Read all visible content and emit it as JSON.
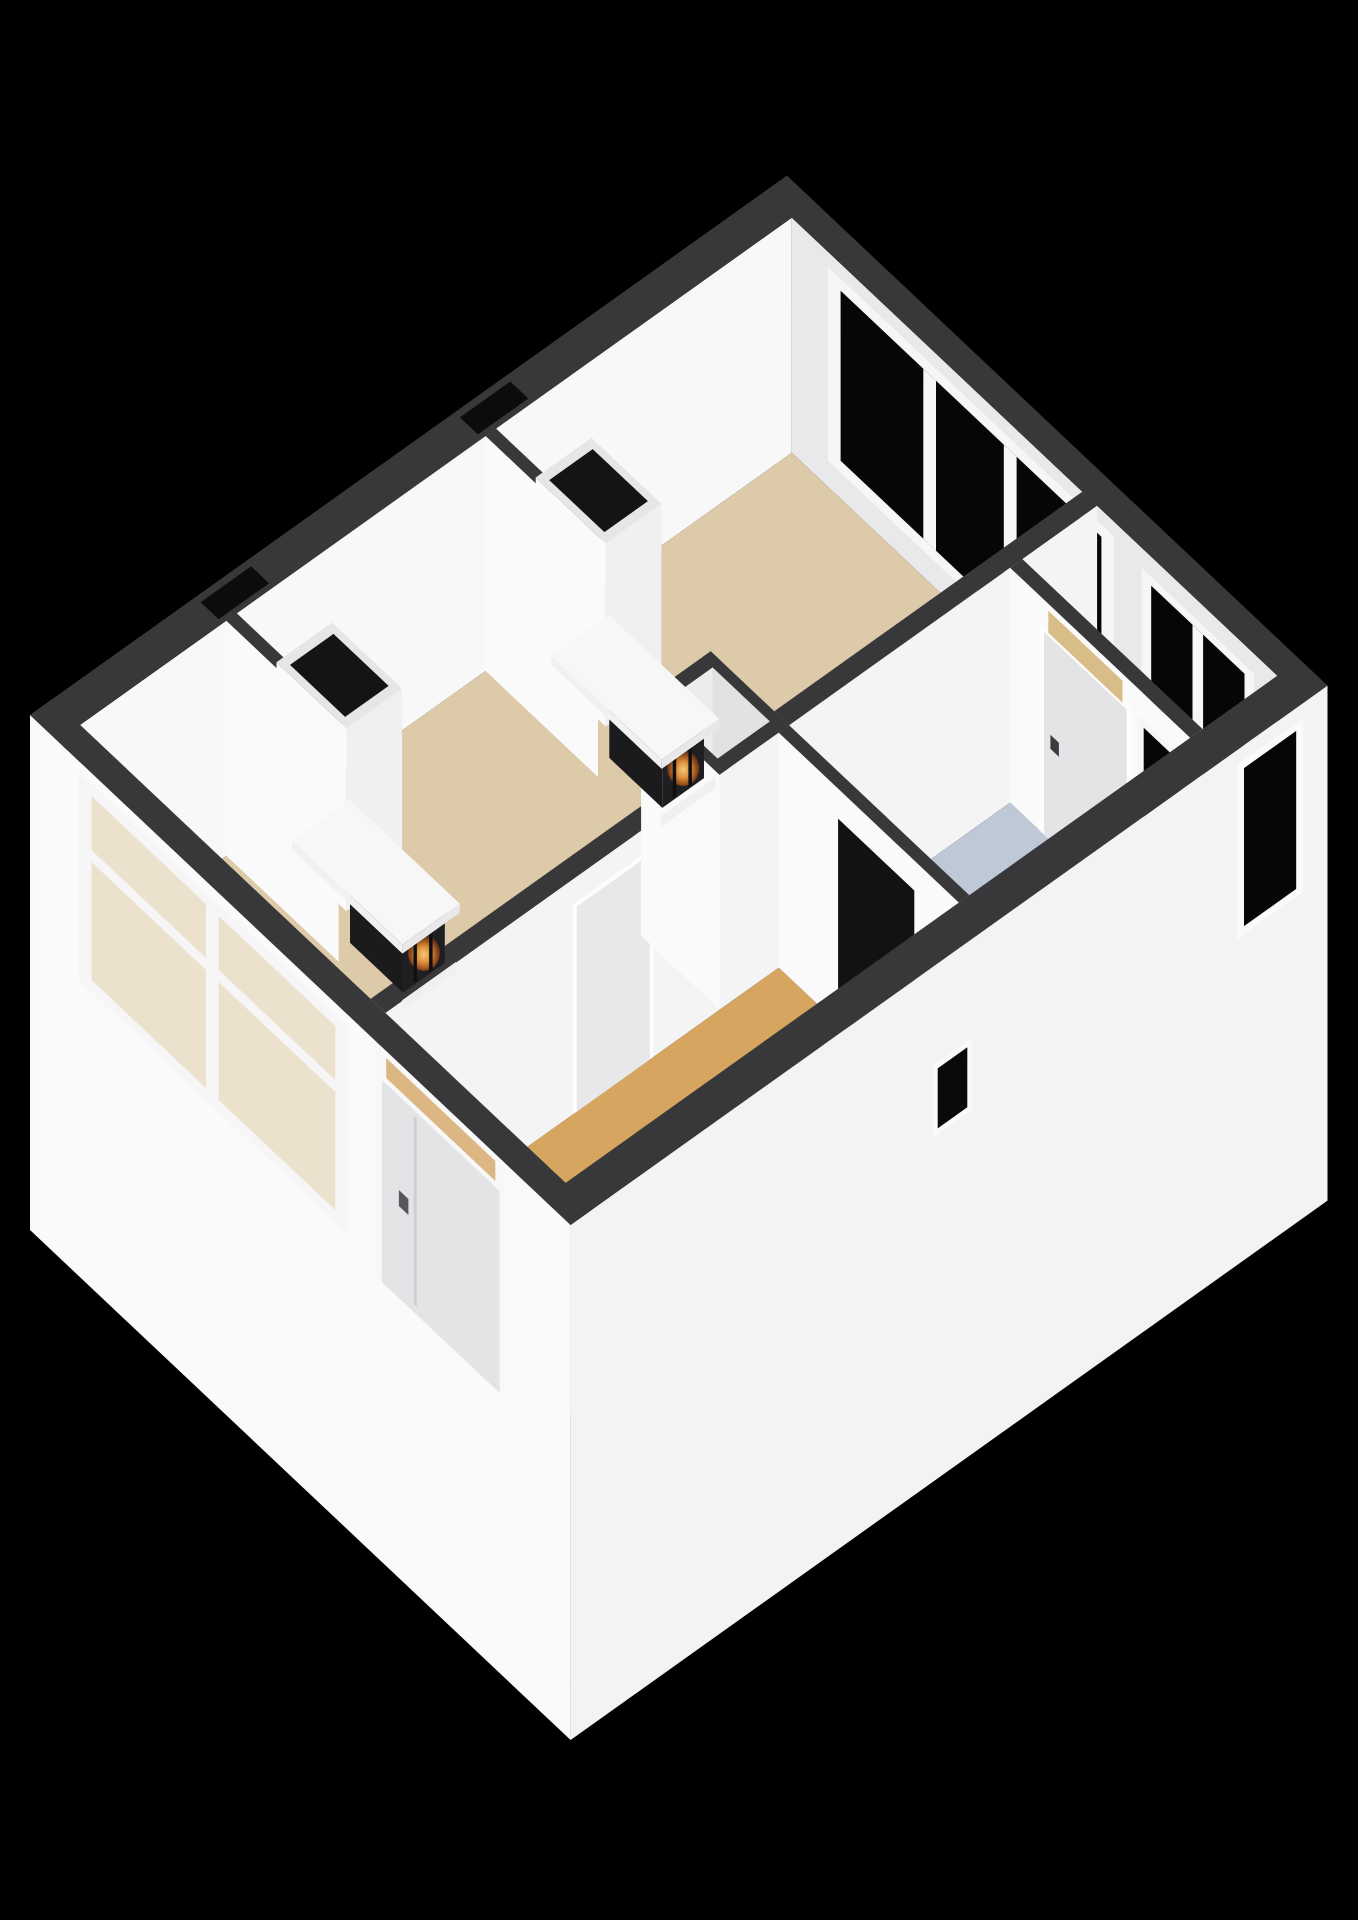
{
  "scene": {
    "type": "3d-floorplan-render",
    "view": "isometric-cutaway",
    "background": "#000000",
    "palette": {
      "wall_top": "#38383a",
      "wall_bright": "#fafafb",
      "wall_light": "#f4f4f5",
      "wall_interior": "#e9e9ec",
      "wall_shaded": "#d9d9dc",
      "frame_white": "#f6f6f7",
      "glass_dark": "#060608",
      "floor_living": "#dccaa8",
      "floor_hall": "#d6a55f",
      "floor_kitchen": "#bfc8d6",
      "floor_closet": "#d2d2d5",
      "floor_annex": "#e6d6b0",
      "door_leaf": "#e4e4e6",
      "door_handle": "#55555a",
      "transom_glass": "rgba(217,176,120,0.92)",
      "sw_glass_tint": "rgba(226,208,170,0.55)",
      "stove_body": "#1f1f22",
      "stove_side": "#1b1b1e",
      "stove_slat": "#0f0f11",
      "flue_dark": "#141416",
      "fire_core": "#ffd27d",
      "fire_mid": "#e8953a",
      "fire_deep": "#90481a",
      "fire_edge": "#2a1a10"
    },
    "rooms": [
      {
        "id": "living-room",
        "floor": "floor_living",
        "features": [
          "large-window-ne",
          "large-window-sw",
          "wood-stove-1",
          "wood-stove-2"
        ]
      },
      {
        "id": "hall",
        "floor": "floor_hall",
        "features": [
          "front-door",
          "staircase",
          "hall-door"
        ]
      },
      {
        "id": "kitchen",
        "floor": "floor_kitchen",
        "features": [
          "kitchen-door",
          "kitchen-window",
          "understair-doorway"
        ]
      },
      {
        "id": "closet",
        "floor": "floor_closet",
        "features": []
      },
      {
        "id": "storage-annex",
        "floor": "floor_annex",
        "features": [
          "annex-window-ne",
          "annex-window-se"
        ]
      }
    ],
    "counts": {
      "windows": 6,
      "doors": 3,
      "stoves": 2,
      "chimney_flues": 2
    },
    "elements": [
      {
        "id": "nw-wall",
        "label": "north-west exterior wall with two flue openings"
      },
      {
        "id": "ne-wall",
        "label": "north-east exterior wall"
      },
      {
        "id": "ne-window-large",
        "label": "large 3-pane window, black glass"
      },
      {
        "id": "annex-window-ne",
        "label": "2-pane annex window, black glass"
      },
      {
        "id": "floor-living-room",
        "label": "tan living room floor"
      },
      {
        "id": "floor-annex",
        "label": "annex floor"
      },
      {
        "id": "floor-kitchen",
        "label": "blue-gray kitchen floor"
      },
      {
        "id": "floor-hall",
        "label": "orange hall floor"
      },
      {
        "id": "partition-wall",
        "label": "long interior partition"
      },
      {
        "id": "hall-door",
        "label": "interior door hall side"
      },
      {
        "id": "closet",
        "label": "small closet box"
      },
      {
        "id": "chimney-breast-1",
        "label": "chimney breast with wood stove"
      },
      {
        "id": "chimney-breast-2",
        "label": "chimney breast with wood stove"
      },
      {
        "id": "staircase-wall",
        "label": "sloped staircase wall"
      },
      {
        "id": "kitchen-sw-wall",
        "label": "kitchen wall with understair doorway"
      },
      {
        "id": "kitchen-door-wall",
        "label": "kitchen wall with door and window"
      },
      {
        "id": "se-wall",
        "label": "south-east exterior wall with stair window and annex window"
      },
      {
        "id": "sw-wall",
        "label": "south-west exterior wall with large window and front door"
      }
    ]
  }
}
